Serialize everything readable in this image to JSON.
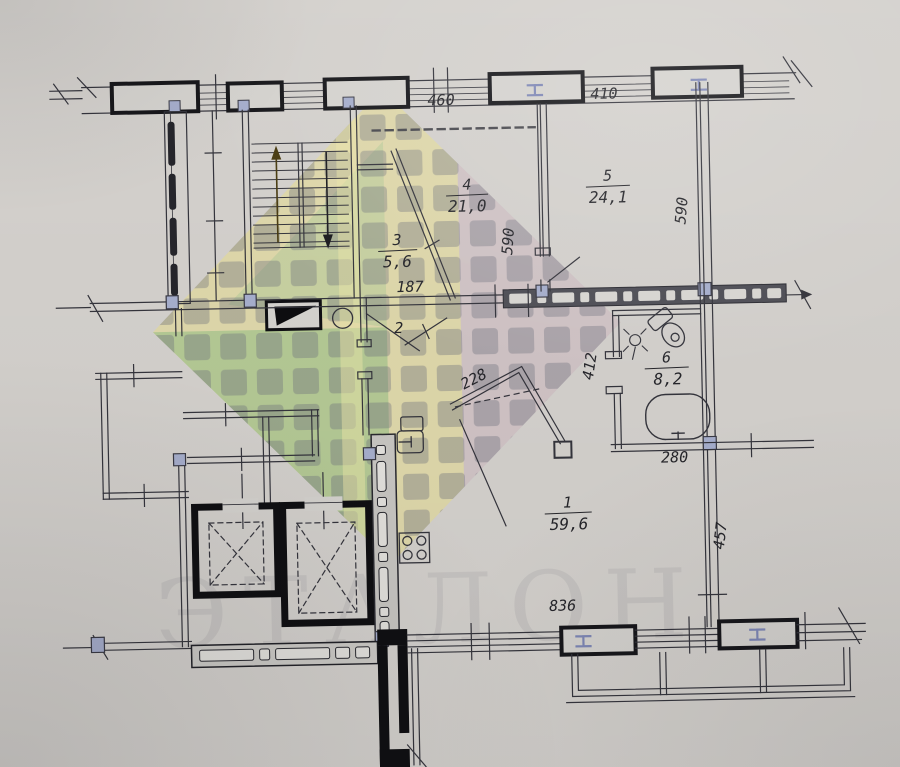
{
  "plan": {
    "watermark_text": "ЭТАЛОН",
    "rooms": {
      "r1": {
        "number": "1",
        "area": "59,6"
      },
      "r2": {
        "number": "2"
      },
      "r3": {
        "number": "3",
        "area": "5,6"
      },
      "r4": {
        "number": "4",
        "area": "21,0"
      },
      "r5": {
        "number": "5",
        "area": "24,1"
      },
      "r6": {
        "number": "6",
        "area": "8,2"
      }
    },
    "dims": {
      "top_left": "460",
      "top_right": "410",
      "room4_depth": "590",
      "room5_depth": "590",
      "hall_width": "187",
      "closet_width": "228",
      "bath_depth": "412",
      "bath_width": "280",
      "right_wall": "457",
      "bottom_width": "836"
    },
    "colors": {
      "paper": "#d7d4d0",
      "ink": "#33333b",
      "wall_black": "#131318",
      "marker_blue": "#a9b1d0",
      "wm_yellow": "rgba(233,224,150,0.60)",
      "wm_green": "rgba(140,190,130,0.50)",
      "wm_purple": "rgba(200,182,220,0.58)"
    }
  }
}
